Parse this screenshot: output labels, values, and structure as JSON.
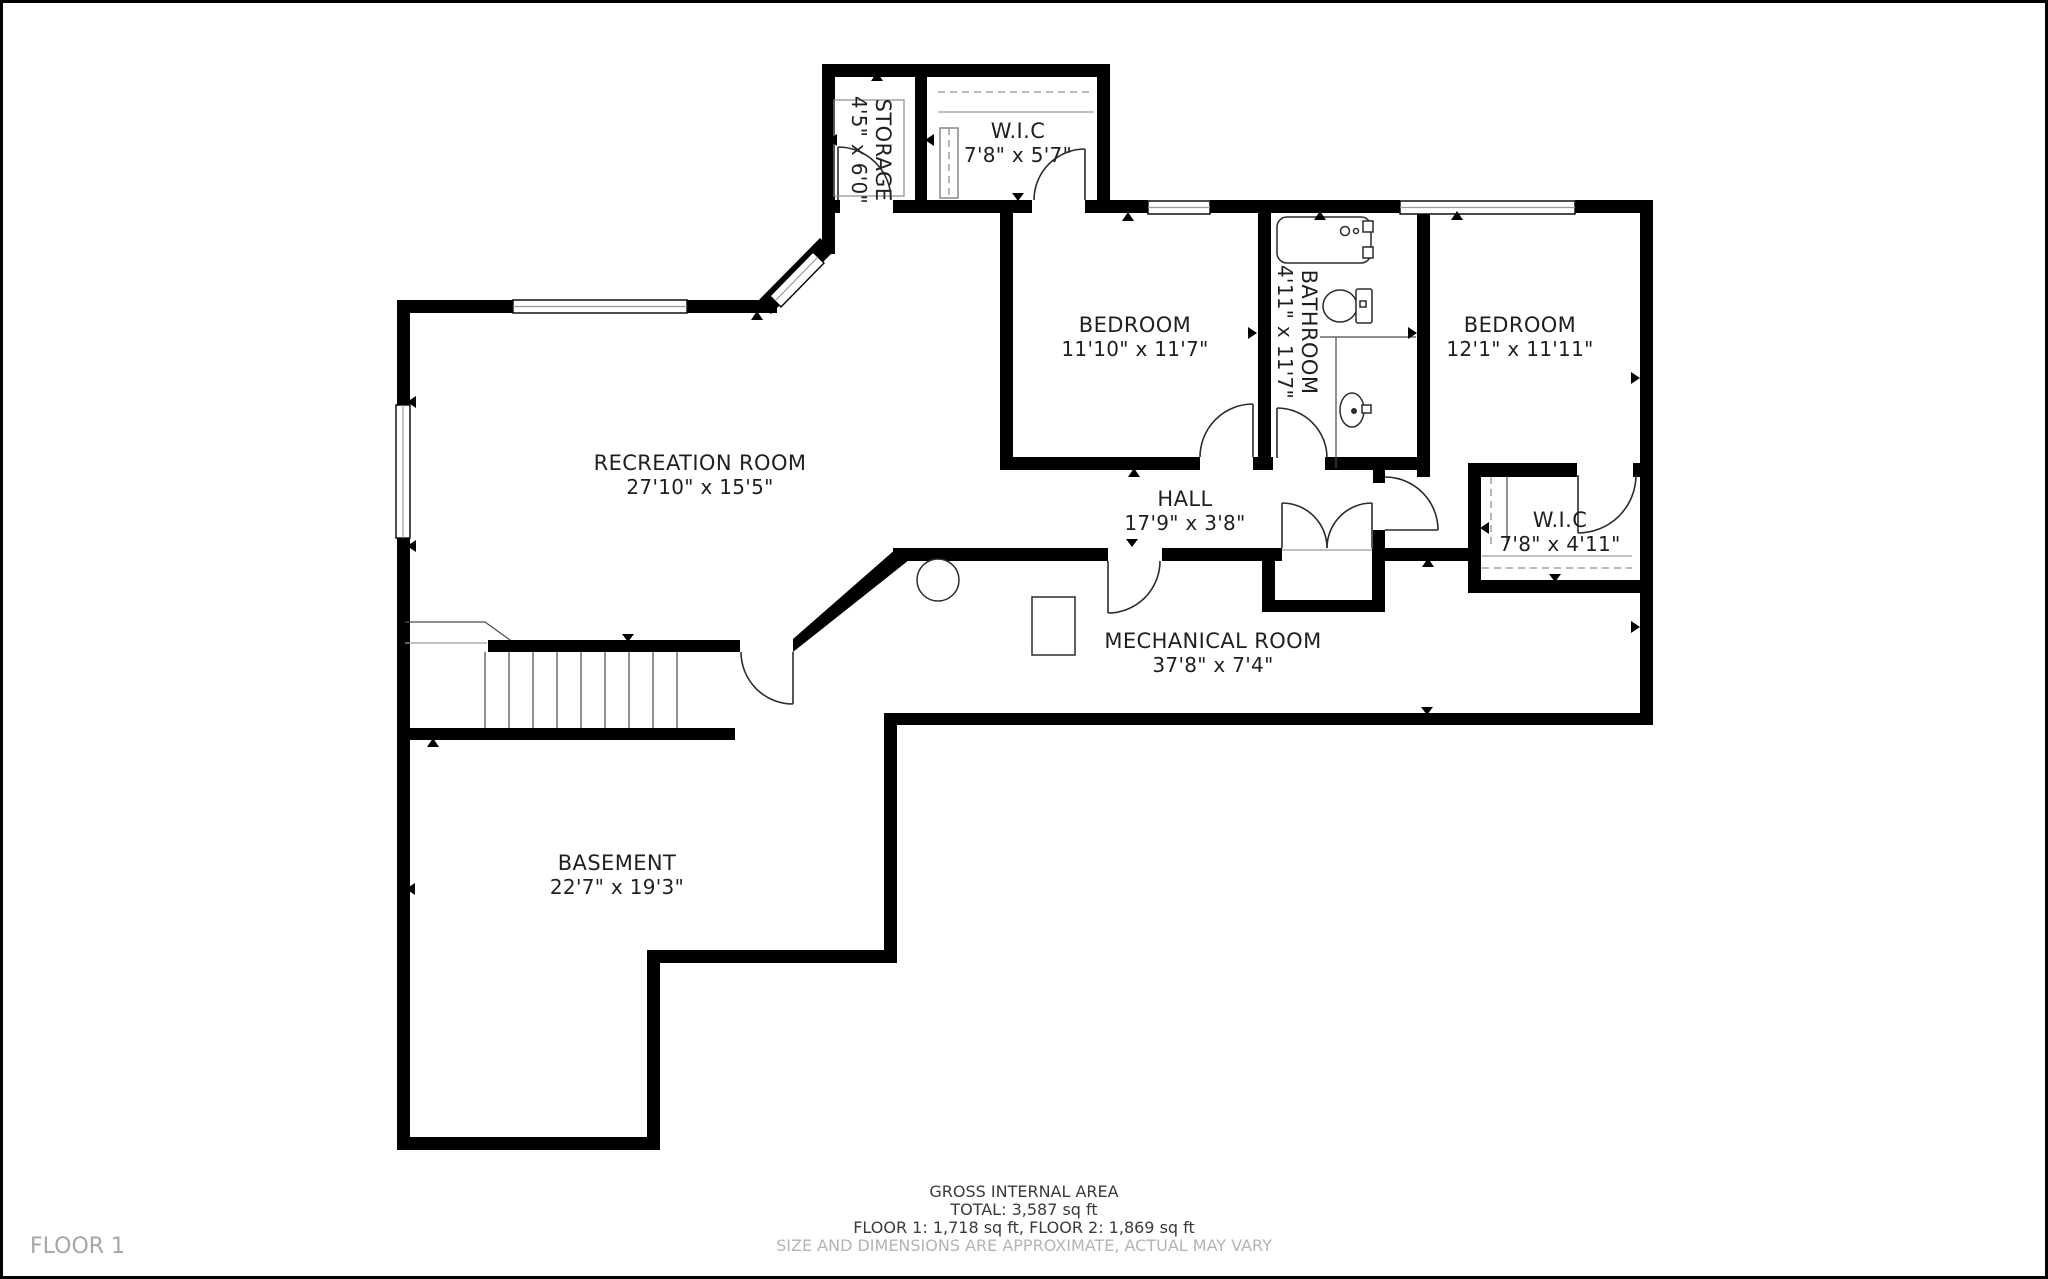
{
  "title": "Floor plan — Floor 1",
  "floor_tag": "FLOOR 1",
  "rooms": {
    "storage": {
      "name": "STORAGE",
      "dims": "4'5\" x 6'0\""
    },
    "wic_upper": {
      "name": "W.I.C",
      "dims": "7'8\" x 5'7\""
    },
    "bedroom1": {
      "name": "BEDROOM",
      "dims": "11'10\" x 11'7\""
    },
    "bathroom": {
      "name": "BATHROOM",
      "dims": "4'11\" x 11'7\""
    },
    "bedroom2": {
      "name": "BEDROOM",
      "dims": "12'1\" x 11'11\""
    },
    "recreation": {
      "name": "RECREATION ROOM",
      "dims": "27'10\" x 15'5\""
    },
    "hall": {
      "name": "HALL",
      "dims": "17'9\" x 3'8\""
    },
    "wic_lower": {
      "name": "W.I.C",
      "dims": "7'8\" x 4'11\""
    },
    "mechanical": {
      "name": "MECHANICAL ROOM",
      "dims": "37'8\" x 7'4\""
    },
    "basement": {
      "name": "BASEMENT",
      "dims": "22'7\" x 19'3\""
    }
  },
  "footer": {
    "line1": "GROSS INTERNAL AREA",
    "line2": "TOTAL: 3,587 sq ft",
    "line3": "FLOOR 1: 1,718 sq ft, FLOOR 2: 1,869 sq ft",
    "line4": "SIZE AND DIMENSIONS ARE APPROXIMATE, ACTUAL MAY VARY"
  },
  "colors": {
    "wall": "#000000",
    "muted_text": "#b4b4b4",
    "floor_tag_text": "#a6a6a6"
  }
}
